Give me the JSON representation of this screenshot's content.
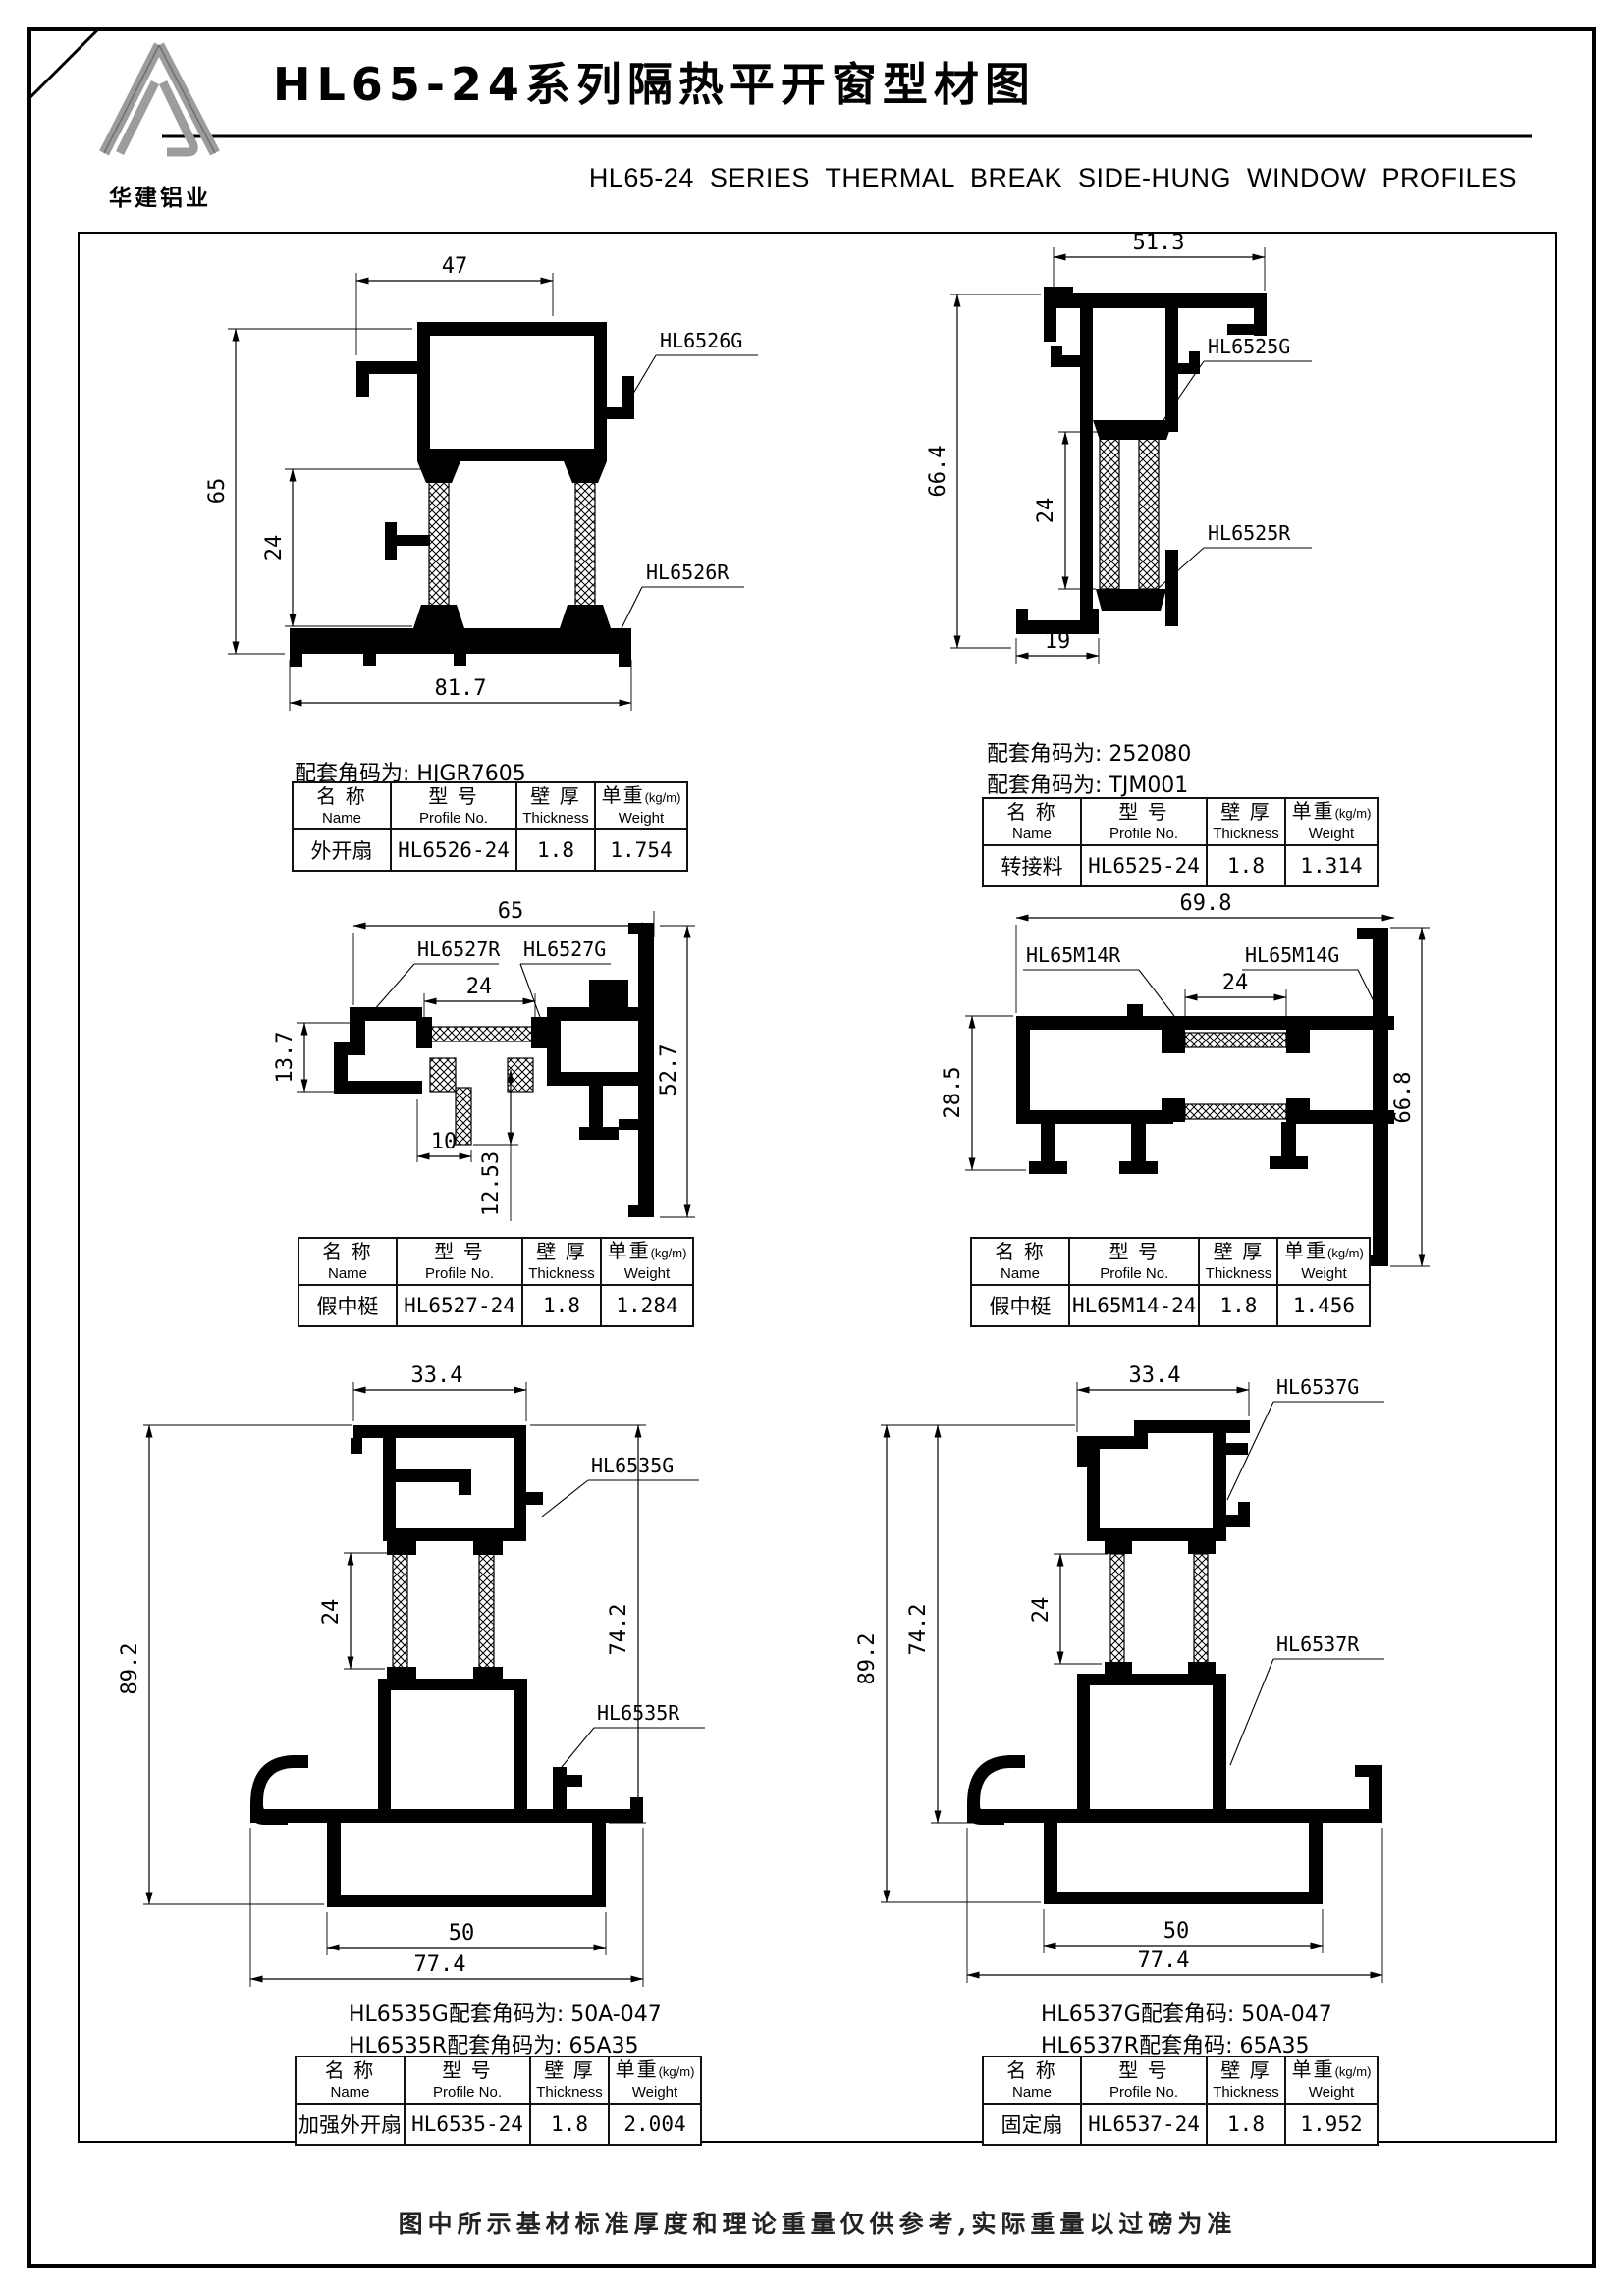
{
  "page": {
    "logo_text": "华建铝业",
    "title_zh": "HL65-24系列隔热平开窗型材图",
    "title_en": "HL65-24  SERIES  THERMAL BREAK SIDE-HUNG  WINDOW  PROFILES",
    "footer_note": "图中所示基材标准厚度和理论重量仅供参考,实际重量以过磅为准"
  },
  "table_headers": {
    "name_zh": "名 称",
    "name_en": "Name",
    "model_zh": "型 号",
    "model_en": "Profile No.",
    "thickness_zh": "壁 厚",
    "thickness_en": "Thickness",
    "weight_zh": "单重",
    "weight_unit": "(kg/m)",
    "weight_en": "Weight"
  },
  "drawings": [
    {
      "labels": {
        "g": "HL6526G",
        "r": "HL6526R"
      },
      "dims": {
        "width_top": "47",
        "height_left": "65",
        "thermal": "24",
        "width_bottom": "81.7"
      },
      "notes": [
        "配套角码为: HJGR7605"
      ],
      "row": {
        "name": "外开扇",
        "profile_no": "HL6526-24",
        "thickness": "1.8",
        "weight": "1.754"
      }
    },
    {
      "labels": {
        "g": "HL6525G",
        "r": "HL6525R"
      },
      "dims": {
        "width_top": "51.3",
        "height_left": "66.4",
        "thermal": "24",
        "width_bottom": "19"
      },
      "notes": [
        "配套角码为: 252080",
        "配套角码为: TJM001"
      ],
      "row": {
        "name": "转接料",
        "profile_no": "HL6525-24",
        "thickness": "1.8",
        "weight": "1.314"
      }
    },
    {
      "labels": {
        "r": "HL6527R",
        "g": "HL6527G"
      },
      "dims": {
        "width_top": "65",
        "thermal": "24",
        "height_left": "13.7",
        "stem_width": "10",
        "stem_drop": "12.53",
        "height_right": "52.7"
      },
      "notes": [],
      "row": {
        "name": "假中梃",
        "profile_no": "HL6527-24",
        "thickness": "1.8",
        "weight": "1.284"
      }
    },
    {
      "labels": {
        "r": "HL65M14R",
        "g": "HL65M14G"
      },
      "dims": {
        "width_top": "69.8",
        "thermal": "24",
        "height_left": "28.5",
        "height_right": "66.8"
      },
      "notes": [],
      "row": {
        "name": "假中梃",
        "profile_no": "HL65M14-24",
        "thickness": "1.8",
        "weight": "1.456"
      }
    },
    {
      "labels": {
        "g": "HL6535G",
        "r": "HL6535R"
      },
      "dims": {
        "width_top": "33.4",
        "height_left": "89.2",
        "thermal": "24",
        "height_right": "74.2",
        "bottom_inner": "50",
        "width_bottom": "77.4"
      },
      "notes": [
        "HL6535G配套角码为: 50A-047",
        "HL6535R配套角码为: 65A35"
      ],
      "row": {
        "name": "加强外开扇",
        "profile_no": "HL6535-24",
        "thickness": "1.8",
        "weight": "2.004"
      }
    },
    {
      "labels": {
        "g": "HL6537G",
        "r": "HL6537R"
      },
      "dims": {
        "width_top": "33.4",
        "height_left": "89.2",
        "height_left2": "74.2",
        "thermal": "24",
        "bottom_inner": "50",
        "width_bottom": "77.4"
      },
      "notes": [
        "HL6537G配套角码: 50A-047",
        "HL6537R配套角码: 65A35"
      ],
      "row": {
        "name": "固定扇",
        "profile_no": "HL6537-24",
        "thickness": "1.8",
        "weight": "1.952"
      }
    }
  ]
}
